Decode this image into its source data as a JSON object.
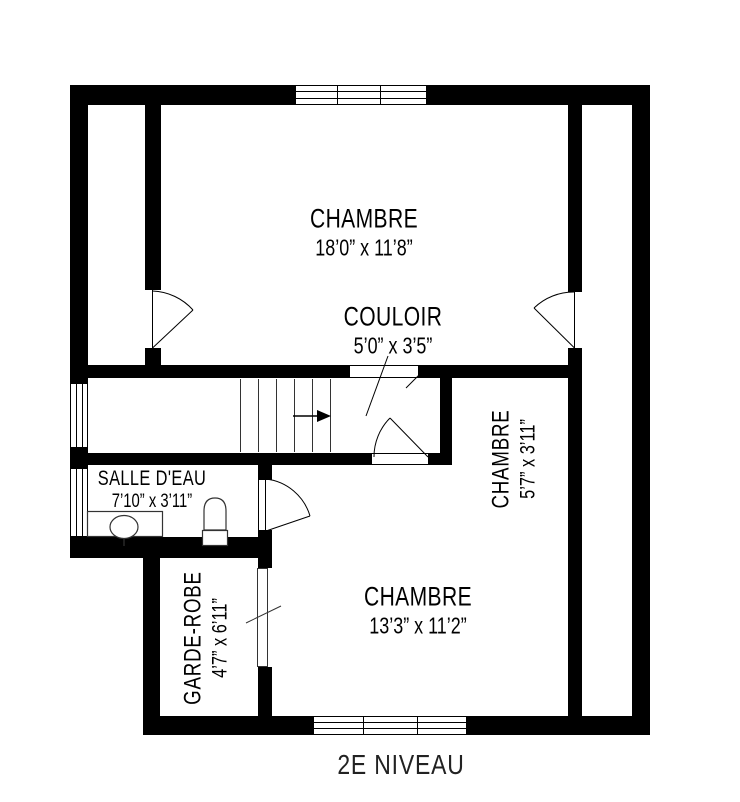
{
  "title": {
    "text": "2E NIVEAU"
  },
  "rooms": {
    "chambre_top": {
      "name": "CHAMBRE",
      "dims": "18’0” x 11’8”"
    },
    "couloir": {
      "name": "COULOIR",
      "dims": "5’0” x 3’5”"
    },
    "chambre_right": {
      "name": "CHAMBRE",
      "dims": "5’7” x 3’11”"
    },
    "salle_deau": {
      "name": "SALLE D'EAU",
      "dims": "7’10” x 3’11”"
    },
    "garde_robe": {
      "name": "GARDE-ROBE",
      "dims": "4’7” x 6’11”"
    },
    "chambre_bottom": {
      "name": "CHAMBRE",
      "dims": "13’3” x 11’2”"
    }
  },
  "symbols": {
    "stair_direction": "right-arrow",
    "fixtures": [
      "toilet",
      "sink-vanity"
    ],
    "doors": [
      "swing-door",
      "sliding-door",
      "cased-opening"
    ],
    "windows": [
      "top-window",
      "left-window-upper",
      "left-window-lower",
      "bottom-window"
    ]
  },
  "colors": {
    "wall": "#000000",
    "background": "#ffffff",
    "thin_line": "#333333",
    "text": "#000000"
  }
}
